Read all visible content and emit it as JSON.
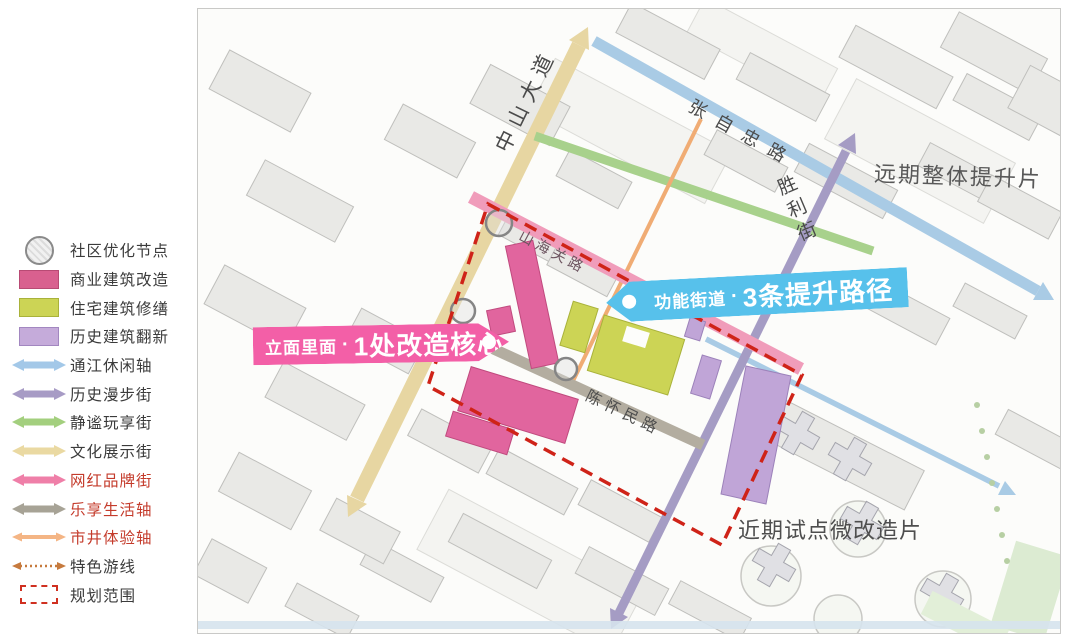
{
  "legend": {
    "items": [
      {
        "label": "社区优化节点",
        "swatch": "node-circle"
      },
      {
        "label": "商业建筑改造",
        "swatch": "rect",
        "color": "#d9608f"
      },
      {
        "label": "住宅建筑修缮",
        "swatch": "rect",
        "color": "#ccd455"
      },
      {
        "label": "历史建筑翻新",
        "swatch": "rect",
        "color": "#c5abda"
      },
      {
        "label": "通江休闲轴",
        "swatch": "double-arrow",
        "color": "#a3c8e8"
      },
      {
        "label": "历史漫步街",
        "swatch": "double-arrow",
        "color": "#a79bc5"
      },
      {
        "label": "静谧玩享街",
        "swatch": "double-arrow",
        "color": "#a3cf7e"
      },
      {
        "label": "文化展示街",
        "swatch": "double-arrow",
        "color": "#ead9a2"
      },
      {
        "label": "网红品牌街",
        "swatch": "double-arrow",
        "color": "#ef7fa8",
        "text_color": "#c43b2b"
      },
      {
        "label": "乐享生活轴",
        "swatch": "double-arrow",
        "color": "#a7a396",
        "text_color": "#c43b2b"
      },
      {
        "label": "市井体验轴",
        "swatch": "thin-double-arrow",
        "color": "#f4b585",
        "text_color": "#c43b2b"
      },
      {
        "label": "特色游线",
        "swatch": "dotted-arrow",
        "color": "#c67a3e"
      },
      {
        "label": "规划范围",
        "swatch": "dashed-box",
        "color": "#d03020"
      }
    ]
  },
  "map": {
    "street_labels": {
      "zhongshan": "中山大道",
      "zhangzizhong": "张自忠路",
      "shengli": "胜利街",
      "shanhaiguan": "山海关路",
      "chenhuaimin": "陈怀民路"
    },
    "zone_labels": {
      "far_term": "远期整体提升片",
      "near_term": "近期试点微改造片"
    },
    "callouts": {
      "facade": {
        "prefix": "立面里面",
        "separator": "·",
        "main": "1处改造核心",
        "color": "#f35fa7"
      },
      "street": {
        "prefix": "功能街道",
        "separator": "·",
        "main": "3条提升路径",
        "color": "#57c1eb"
      }
    },
    "colors": {
      "boundary_red": "#cf2318",
      "road_tan": "#e7d6a2",
      "road_blue": "#a9cbe5",
      "road_purple": "#a59cc4",
      "road_green": "#a8d18c",
      "road_pink": "#f09cba",
      "road_gray": "#b3ada0",
      "road_orange": "#f0ac74"
    }
  }
}
